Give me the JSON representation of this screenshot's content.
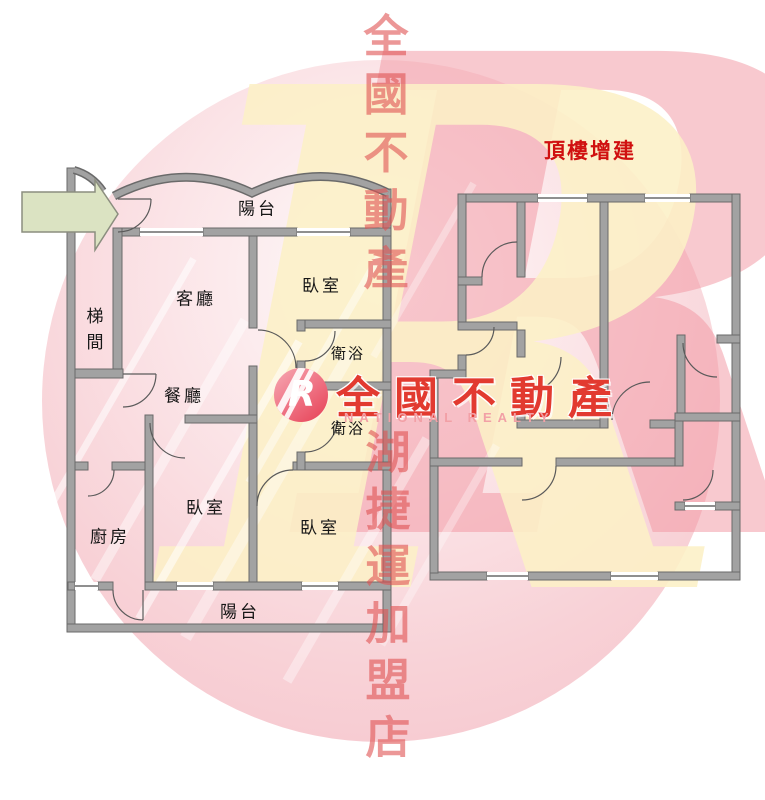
{
  "floorplan_left": {
    "rooms": {
      "balcony_top": "陽台",
      "stairwell": "梯間",
      "living_room": "客廳",
      "bedroom_top": "臥室",
      "bathroom_upper": "衛浴",
      "dining_room": "餐廳",
      "bathroom_lower": "衛浴",
      "kitchen": "廚房",
      "bedroom_center": "臥室",
      "bedroom_right": "臥室",
      "balcony_bottom": "陽台"
    }
  },
  "floorplan_right": {
    "title": "頂樓增建"
  },
  "watermark": {
    "column_top": "全國不動產",
    "column_bottom": "湖捷運加盟店",
    "giant_letter": "R",
    "logo": {
      "badge_letter": "R",
      "brand_cn": "全國不動產",
      "brand_en": "NATIONAL REALTY"
    }
  },
  "colors": {
    "wall_fill": "#a2a2a2",
    "wall_outline": "#6a6a6a",
    "circle_pink": "#f5c3cb",
    "ghost_yellow": "#fcf0c6",
    "ghost_pink": "#f194a0",
    "watermark_red": "#df5252",
    "title_red": "#d01010",
    "brand_red": "#e23a30",
    "brand_pink": "#f2a0a6",
    "arrow_green": "#dbe3c2"
  }
}
